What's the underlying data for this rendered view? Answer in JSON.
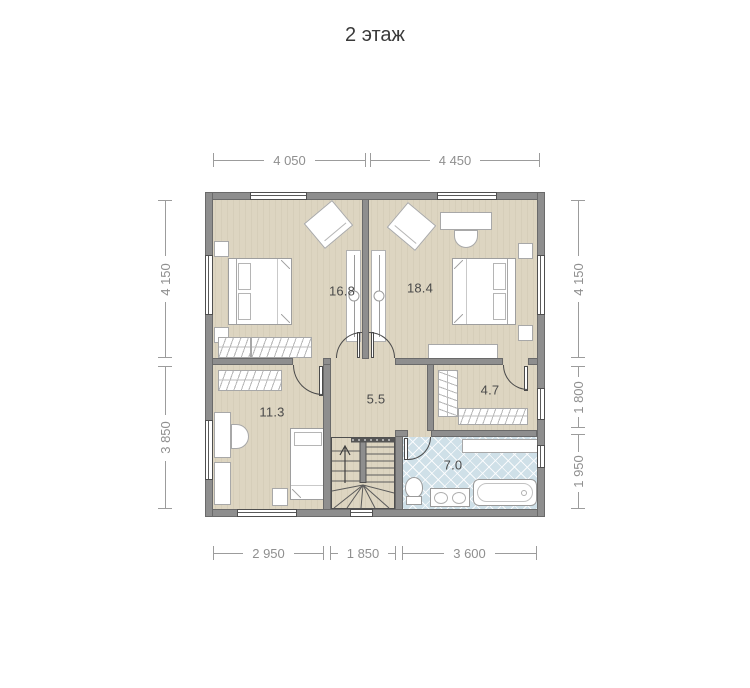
{
  "title": "2 этаж",
  "dimensions": {
    "top": [
      "4 050",
      "4 450"
    ],
    "left": [
      "4 150",
      "3 850"
    ],
    "right": [
      "4 150",
      "1 800",
      "1 950"
    ],
    "bottom": [
      "2 950",
      "1 850",
      "3 600"
    ]
  },
  "rooms": [
    {
      "area": "16.8"
    },
    {
      "area": "18.4"
    },
    {
      "area": "11.3"
    },
    {
      "area": "5.5"
    },
    {
      "area": "4.7"
    },
    {
      "area": "7.0"
    }
  ],
  "colors": {
    "wall": "#8e8e8e",
    "floor": "#ddd5c1",
    "bathroom_tile": "#cfe0e8",
    "dimension_text": "#8f8f8f",
    "room_label": "#4a4a4a",
    "title": "#3a3a3a"
  }
}
